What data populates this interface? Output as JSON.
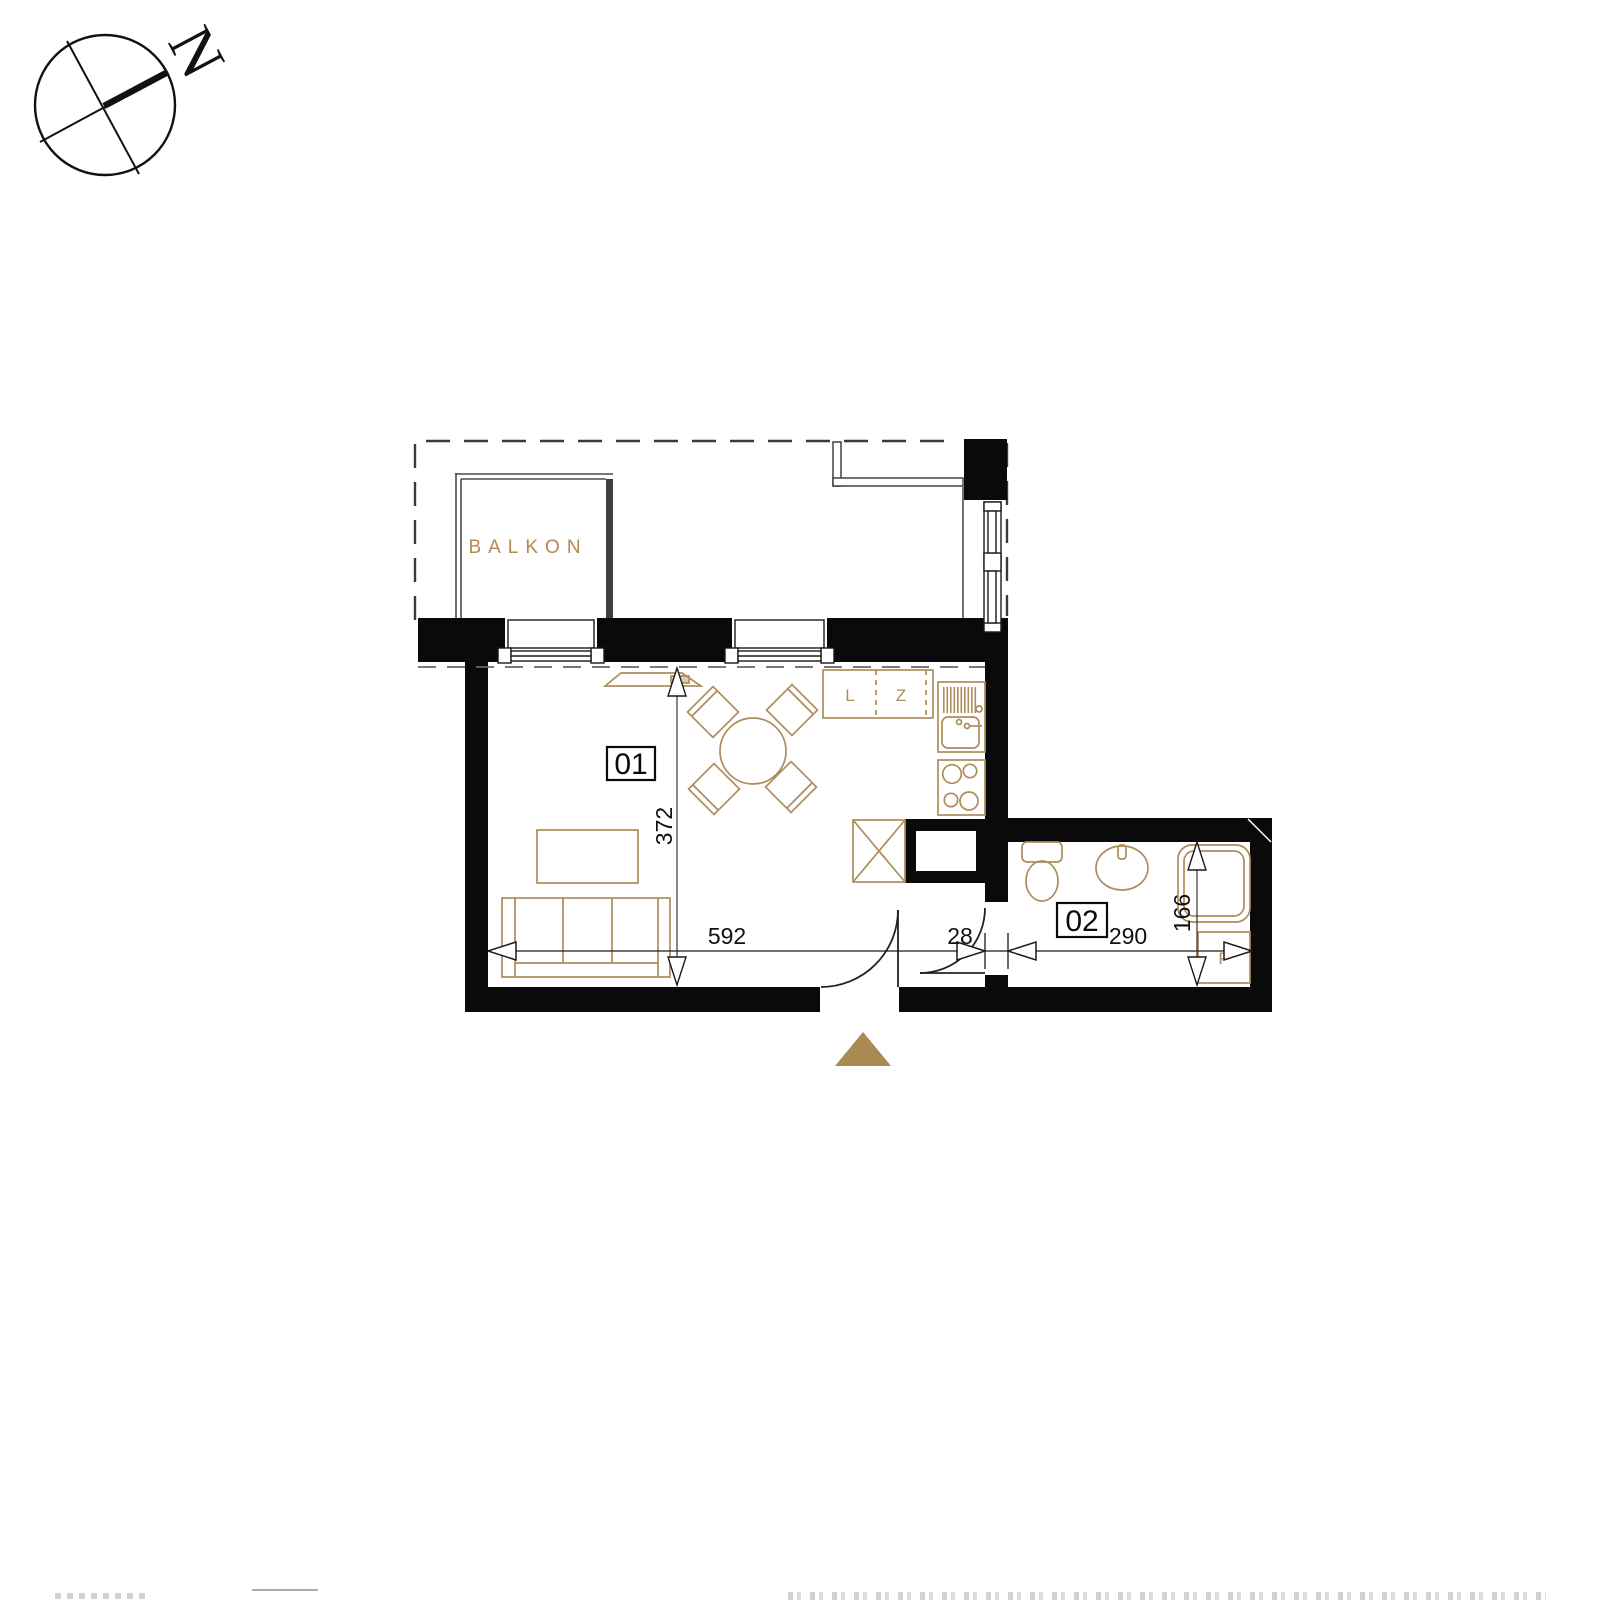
{
  "compass": {
    "north_label": "N"
  },
  "balcony": {
    "label": "BALKON"
  },
  "rooms": {
    "living": {
      "number": "01"
    },
    "bathroom": {
      "number": "02"
    }
  },
  "kitchen": {
    "cabinet_left_label": "L",
    "cabinet_right_label": "Z"
  },
  "bathroom": {
    "washing_machine_label": "P"
  },
  "dimensions": {
    "living_width": "592",
    "wall_thickness": "28",
    "bathroom_width": "290",
    "living_depth": "372",
    "bathroom_depth": "166"
  },
  "colors": {
    "wall_fill": "#0a0a0a",
    "furniture_line": "#ad8d5c",
    "gold_text": "#b3894f",
    "entrance_marker": "#a98a52"
  }
}
